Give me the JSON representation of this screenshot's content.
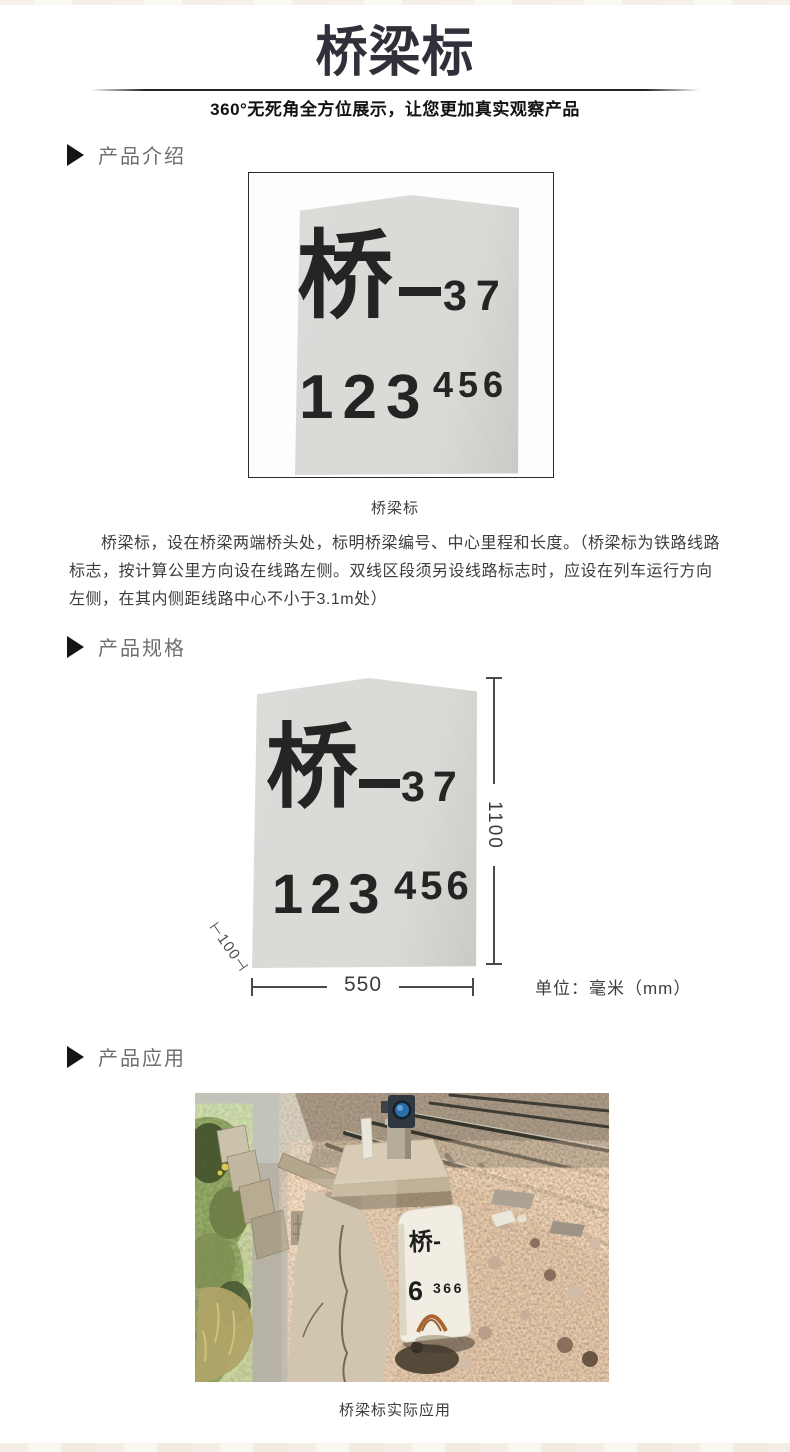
{
  "header": {
    "title": "桥梁标",
    "subtitle": "360°无死角全方位展示，让您更加真实观察产品"
  },
  "sections": {
    "intro_label": "产品介绍",
    "spec_label": "产品规格",
    "application_label": "产品应用"
  },
  "marker_stone": {
    "prefix_char": "桥",
    "dash": "—",
    "bridge_number": "37",
    "mileage_main": "123",
    "mileage_sup": "456"
  },
  "intro": {
    "caption": "桥梁标",
    "description": "桥梁标，设在桥梁两端桥头处，标明桥梁编号、中心里程和长度。（桥梁标为铁路线路标志，按计算公里方向设在线路左侧。双线区段须另设线路标志时，应设在列车运行方向左侧，在其内侧距线路中心不小于3.1m处）"
  },
  "spec": {
    "height_mm": "1100",
    "width_mm": "550",
    "thickness_mm": "⊢100⊣",
    "unit": "单位：毫米（mm）"
  },
  "application": {
    "caption": "桥梁标实际应用",
    "photo_stone": {
      "line1": "桥-",
      "number_main": "6",
      "number_sub": "366"
    }
  },
  "colors": {
    "title": "#30303a",
    "section_label": "#6f6f6f",
    "section_arrow": "#141414",
    "stone_fill": "#d9d9d6",
    "stone_text": "#242424",
    "body_text": "#3d3d3d",
    "dimension_line": "#4a4a4a",
    "figure_border": "#2b2b2b"
  }
}
